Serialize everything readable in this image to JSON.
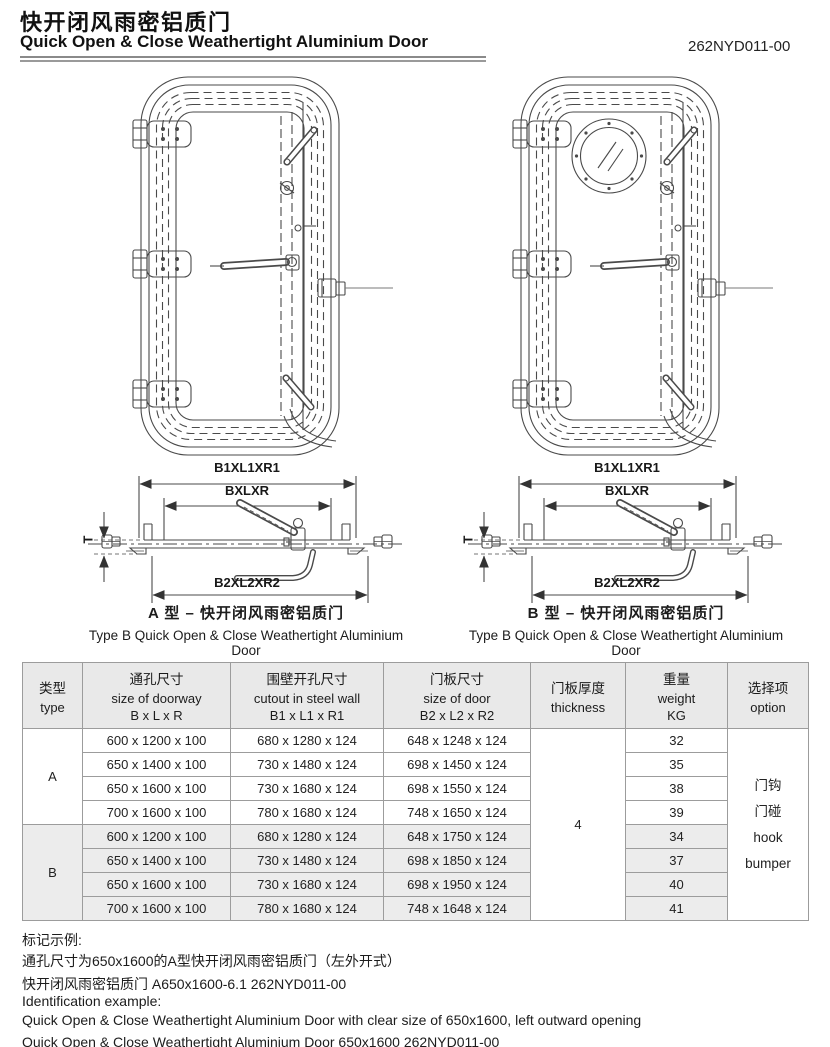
{
  "header": {
    "title_cn": "快开闭风雨密铝质门",
    "title_en": "Quick Open & Close Weathertight Aluminium Door",
    "doc_no": "262NYD011-00"
  },
  "diagrams": {
    "dim_labels": {
      "outer": "B1XL1XR1",
      "inner": "BXLXR",
      "bottom": "B2XL2XR2",
      "thickness": "T"
    },
    "type_a": {
      "caption_cn": "A 型 – 快开闭风雨密铝质门",
      "caption_en": "Type B Quick Open & Close Weathertight Aluminium Door"
    },
    "type_b": {
      "caption_cn": "B 型 – 快开闭风雨密铝质门",
      "caption_en": "Type B Quick Open & Close Weathertight Aluminium Door"
    }
  },
  "table": {
    "headers": {
      "type_cn": "类型",
      "type_en": "type",
      "doorway_cn": "通孔尺寸",
      "doorway_en": "size of doorway",
      "doorway_dim": "B x L x R",
      "cutout_cn": "围壁开孔尺寸",
      "cutout_en": "cutout in steel wall",
      "cutout_dim": "B1 x L1 x R1",
      "door_cn": "门板尺寸",
      "door_en": "size of door",
      "door_dim": "B2 x L2 x R2",
      "thickness_cn": "门板厚度",
      "thickness_en": "thickness",
      "weight_cn": "重量",
      "weight_en": "weight",
      "weight_unit": "KG",
      "option_cn": "选择项",
      "option_en": "option"
    },
    "thickness_value": "4",
    "option_lines": [
      "门钩",
      "门碰",
      "hook",
      "bumper"
    ],
    "groups": [
      {
        "type": "A",
        "rows": [
          {
            "doorway": "600 x 1200 x 100",
            "cutout": "680 x 1280 x 124",
            "door": "648 x 1248 x 124",
            "weight": "32"
          },
          {
            "doorway": "650 x 1400 x 100",
            "cutout": "730 x 1480 x 124",
            "door": "698 x 1450 x 124",
            "weight": "35"
          },
          {
            "doorway": "650 x 1600 x 100",
            "cutout": "730 x 1680 x 124",
            "door": "698 x 1550 x 124",
            "weight": "38"
          },
          {
            "doorway": "700 x 1600 x 100",
            "cutout": "780 x 1680 x 124",
            "door": "748 x 1650 x 124",
            "weight": "39"
          }
        ]
      },
      {
        "type": "B",
        "rows": [
          {
            "doorway": "600 x 1200 x 100",
            "cutout": "680 x 1280 x 124",
            "door": "648 x 1750 x 124",
            "weight": "34"
          },
          {
            "doorway": "650 x 1400 x 100",
            "cutout": "730 x 1480 x 124",
            "door": "698 x 1850 x 124",
            "weight": "37"
          },
          {
            "doorway": "650 x 1600 x 100",
            "cutout": "730 x 1680 x 124",
            "door": "698 x 1950 x 124",
            "weight": "40"
          },
          {
            "doorway": "700 x 1600 x 100",
            "cutout": "780 x 1680 x 124",
            "door": "748 x 1648 x 124",
            "weight": "41"
          }
        ]
      }
    ]
  },
  "notes": {
    "cn_title": "标记示例:",
    "cn_line1": "通孔尺寸为650x1600的A型快开闭风雨密铝质门（左外开式）",
    "cn_line2": "快开闭风雨密铝质门 A650x1600-6.1 262NYD011-00",
    "en_title": "Identification example:",
    "en_line1": "Quick Open & Close Weathertight Aluminium Door with clear size of 650x1600, left outward opening",
    "en_line2": "Quick Open & Close Weathertight Aluminium Door 650x1600 262NYD011-00"
  }
}
